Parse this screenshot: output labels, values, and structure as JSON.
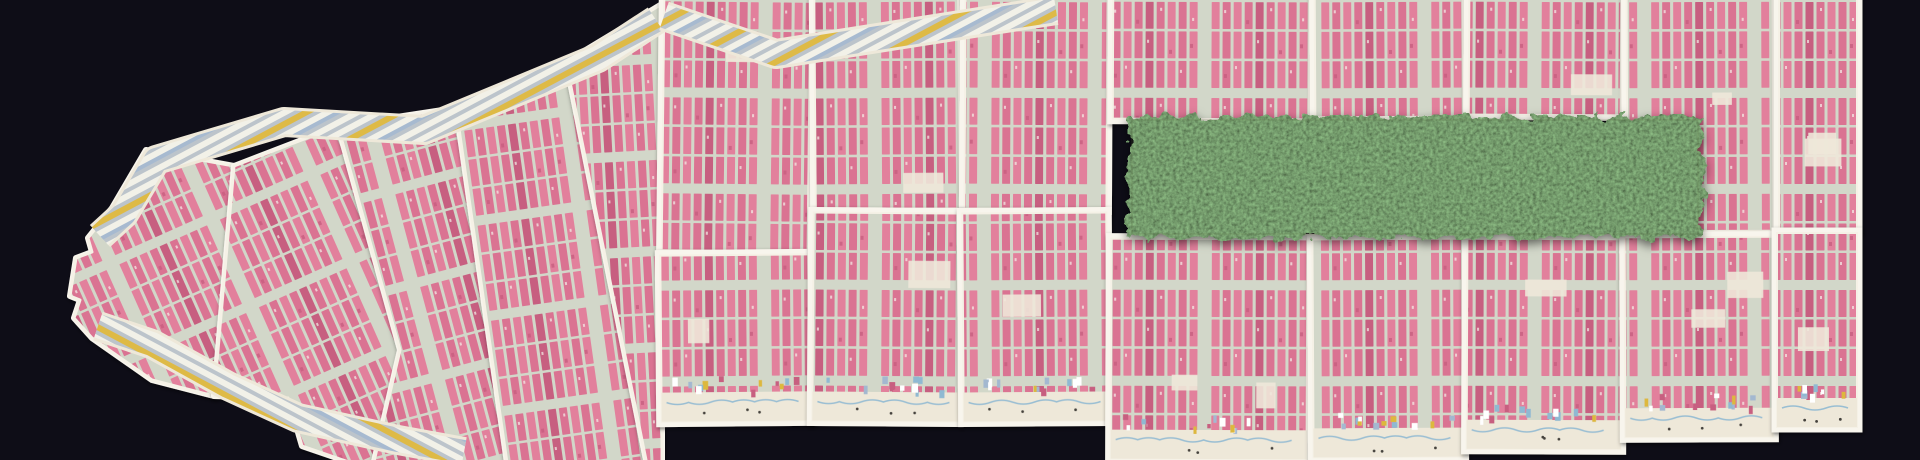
{
  "scene": {
    "title": "Mosaic of Manhattan insurance-atlas map plates on a dark ground with Central Park shown as a rectangle of real green foliage",
    "map_label": "manhattan-atlas-mosaic",
    "park_label": "central-park-foliage",
    "pier_label": "waterfront-pier-band",
    "plate_label": "atlas-plate"
  },
  "colors": {
    "background": "#0e0d17",
    "paper": "#ece4d3",
    "paper_edge": "#f5f1e6",
    "seam": "#f8f5ed",
    "street": "#d2d7c9",
    "block_pink": "#e2809c",
    "block_pink_alt": "#da7392",
    "block_pink_deep": "#c75e80",
    "block_fleck": "#f6f1ea",
    "pier_light": "#f2f1e9",
    "pier_gray": "#b9c2ca",
    "pier_yellow": "#ddb83e",
    "pier_blue": "#a3b8d0",
    "shore_paper": "#eee8d9",
    "shore_blue": "#8fb9d2",
    "park_base": "#2c3a20",
    "park_light": "#4e6133",
    "shadow": "#000000"
  }
}
